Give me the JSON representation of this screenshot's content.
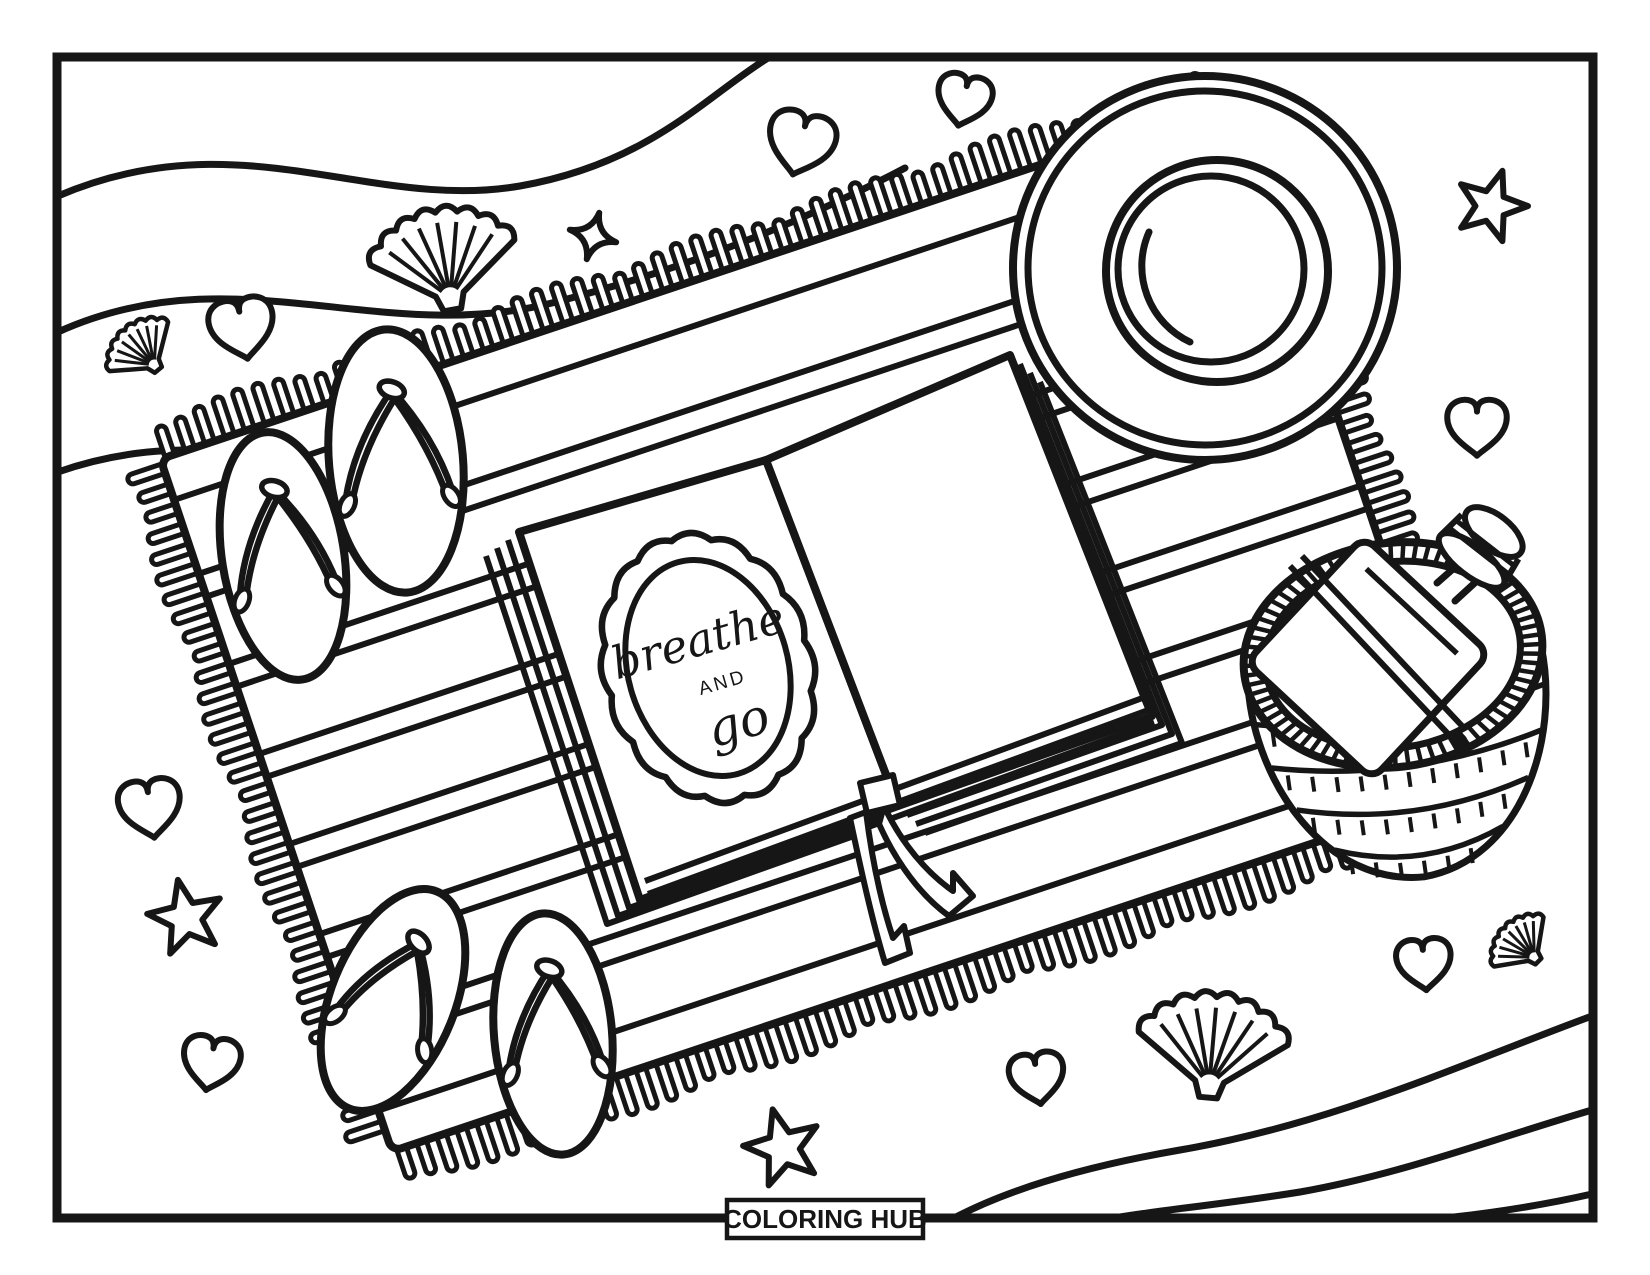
{
  "page": {
    "background_color": "#ffffff",
    "line_color": "#161616",
    "description": "Black-and-white beach picnic coloring page: fringed striped towel with an open journal, sun hat, woven basket holding a bottle, two pairs of flip flops, hearts, stars, seashells and wavy water lines",
    "orientation": "landscape"
  },
  "book": {
    "quote_line1": "breathe",
    "quote_line2": "AND",
    "quote_line3": "go"
  },
  "footer": {
    "brand_label": "COLORING HUB"
  },
  "scene": {
    "objects": [
      "beach-towel",
      "open-journal",
      "sun-hat",
      "picnic-basket",
      "water-bottle",
      "flip-flops-top-pair",
      "flip-flops-bottom-pair",
      "waves-top-left",
      "waves-bottom-right"
    ],
    "towel": {
      "cx": 812,
      "cy": 626,
      "width": 1130,
      "height": 730,
      "rotation": -18.5,
      "border_line_offset": 322,
      "stripe_pair_centers": [
        -232,
        -137,
        -42,
        53,
        148,
        243
      ],
      "stripe_halfgap": 12,
      "fringe_spacing": 21
    },
    "hat": {
      "cx": 1205,
      "cy": 268,
      "brim_radius": 192,
      "brim_inner_radius": 177,
      "crown_radius": 111,
      "crown_inner_radius": 93
    },
    "basket": {
      "cx": 1393,
      "cy": 655,
      "rotation": -8,
      "rim_rx": 150,
      "rim_ry": 112,
      "rim_inner_rx": 128,
      "rim_inner_ry": 93,
      "depth": 224
    },
    "bottle": {
      "cx": 1368,
      "cy": 658,
      "size": 172,
      "rotation": 43,
      "cap_cx": 1479,
      "cap_cy": 551,
      "cap_rotation": 38
    },
    "sandals": [
      {
        "x": 396,
        "y": 461,
        "length": 264,
        "width": 134,
        "rotation": -5
      },
      {
        "x": 283,
        "y": 556,
        "length": 250,
        "width": 122,
        "rotation": -9
      },
      {
        "x": 393,
        "y": 1000,
        "length": 234,
        "width": 124,
        "rotation": 22
      },
      {
        "x": 553,
        "y": 1034,
        "length": 242,
        "width": 118,
        "rotation": -5
      }
    ],
    "decorations": [
      {
        "type": "heart",
        "x": 242,
        "y": 327,
        "size": 52,
        "rotation": -10
      },
      {
        "type": "heart",
        "x": 801,
        "y": 142,
        "size": 54,
        "rotation": 14
      },
      {
        "type": "heart",
        "x": 964,
        "y": 99,
        "size": 44,
        "rotation": 12
      },
      {
        "type": "heart",
        "x": 1477,
        "y": 426,
        "size": 48,
        "rotation": 0
      },
      {
        "type": "heart",
        "x": 150,
        "y": 807,
        "size": 50,
        "rotation": -8
      },
      {
        "type": "heart",
        "x": 211,
        "y": 1062,
        "size": 46,
        "rotation": 10
      },
      {
        "type": "heart",
        "x": 1037,
        "y": 1077,
        "size": 44,
        "rotation": -8
      },
      {
        "type": "heart",
        "x": 1424,
        "y": 963,
        "size": 44,
        "rotation": -5
      },
      {
        "type": "star",
        "x": 1491,
        "y": 206,
        "size": 74,
        "rotation": 18
      },
      {
        "type": "star",
        "x": 186,
        "y": 918,
        "size": 78,
        "rotation": -12
      },
      {
        "type": "star",
        "x": 783,
        "y": 1148,
        "size": 80,
        "rotation": -15
      },
      {
        "type": "sparkle",
        "x": 593,
        "y": 236,
        "size": 48,
        "rotation": 15
      },
      {
        "type": "shell",
        "x": 443,
        "y": 256,
        "size": 88,
        "rotation": -10
      },
      {
        "type": "shell",
        "x": 1213,
        "y": 1042,
        "size": 90,
        "rotation": 5
      },
      {
        "type": "shell",
        "x": 140,
        "y": 348,
        "size": 46,
        "rotation": -40
      },
      {
        "type": "shell",
        "x": 1520,
        "y": 943,
        "size": 42,
        "rotation": -45
      }
    ]
  }
}
